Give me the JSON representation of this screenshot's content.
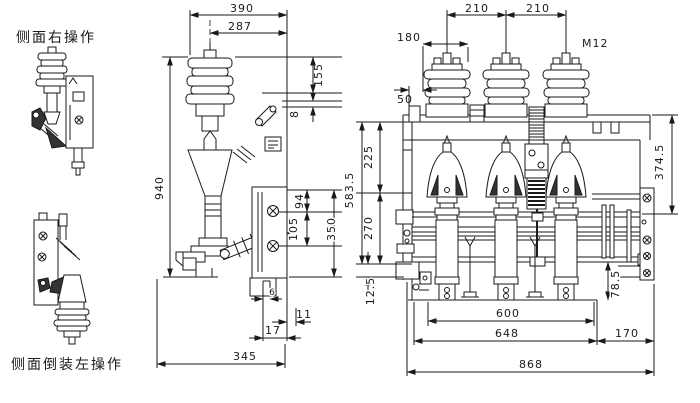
{
  "drawing": {
    "captions": {
      "side_right": "侧面右操作",
      "side_inverted_left": "侧面倒装左操作"
    },
    "colors": {
      "line": "#1a1a1a",
      "background": "#ffffff",
      "dark_fill": "#333333"
    },
    "side_view_dims": {
      "width_390": "390",
      "width_287": "287",
      "height_155": "155",
      "gap_8": "8",
      "height_940": "940",
      "hole_pitch_94": "94",
      "hole_pitch_105": "105",
      "plate_height_350": "350",
      "slot_6": "6",
      "offset_11": "11",
      "offset_17": "17",
      "base_width_345": "345"
    },
    "front_view_dims": {
      "pole_pitch_left": "210",
      "pole_pitch_right": "210",
      "insulator_width_180": "180",
      "terminal_thread": "M12",
      "offset_50": "50",
      "height_225": "225",
      "height_583_5": "583.5",
      "height_270": "270",
      "offset_12_5": "12.5",
      "height_374_5": "374.5",
      "depth_78_5": "78.5",
      "base_width_600": "600",
      "base_width_648": "648",
      "side_offset_170": "170",
      "total_width_868": "868"
    }
  }
}
